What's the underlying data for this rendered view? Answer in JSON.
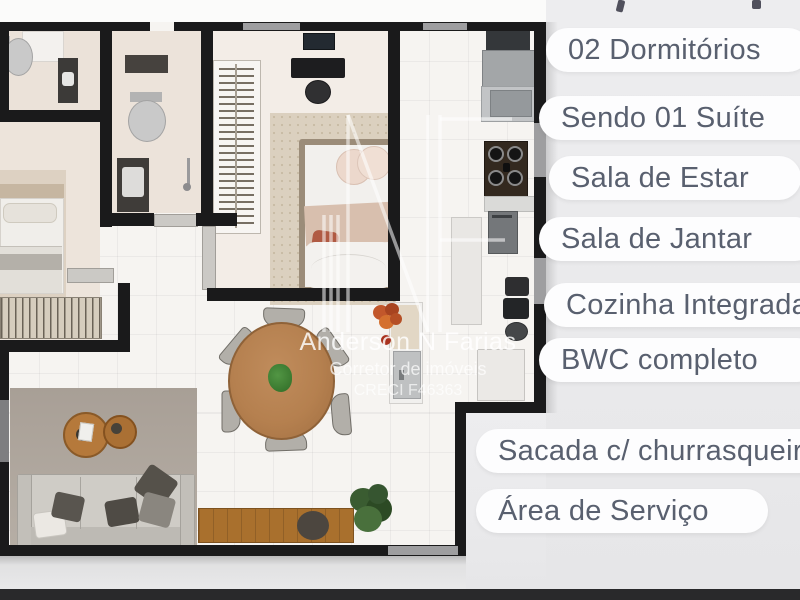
{
  "panel": {
    "features": [
      {
        "label": "02 Dormitórios"
      },
      {
        "label": "Sendo 01 Suíte"
      },
      {
        "label": "Sala de Estar"
      },
      {
        "label": "Sala de Jantar"
      },
      {
        "label": "Cozinha Integrada"
      },
      {
        "label": "BWC completo"
      },
      {
        "label": "Sacada c/ churrasqueira"
      },
      {
        "label": "Área de Serviço"
      }
    ],
    "pill_color": "#fdfdfe",
    "text_color": "#59606f",
    "background": "#ebebed"
  },
  "watermark": {
    "logo": "NF monogram",
    "name": "Anderson N Farias",
    "role": "Corretor de imóveis",
    "license": "CRECI F46363"
  },
  "floorplan": {
    "style": "top-view 3D rendered apartment plan",
    "wall_color": "#1a1a1b",
    "floor_color": "#f6f4f1",
    "accent_wood": "#b5804f",
    "bottom_bar_color": "#29292b"
  }
}
